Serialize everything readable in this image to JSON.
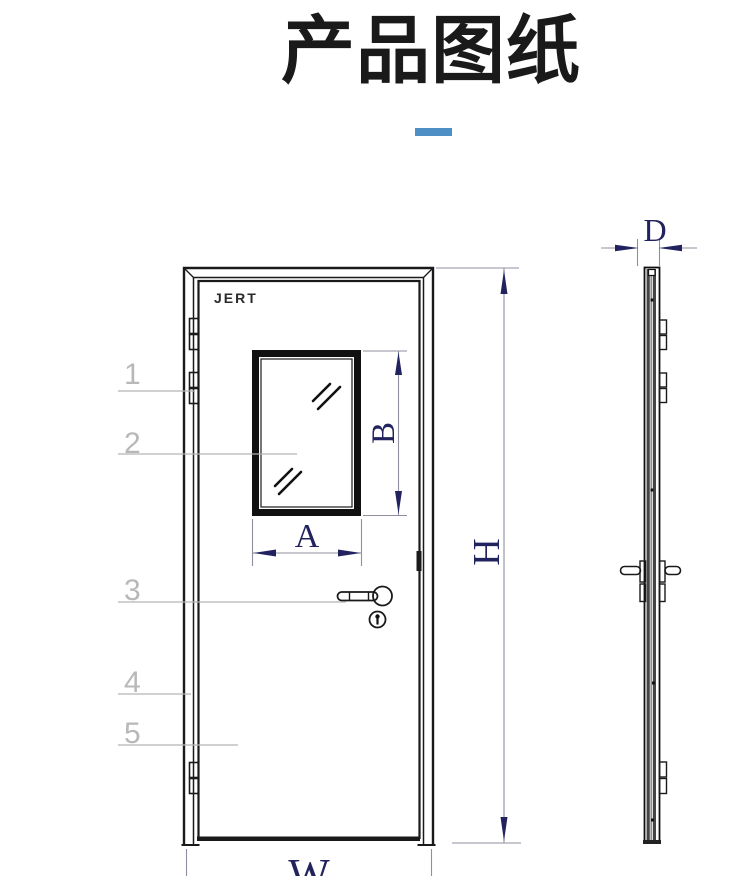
{
  "title": {
    "text": "产品图纸"
  },
  "drawing": {
    "brand_label": "JERT",
    "callouts": [
      "1",
      "2",
      "3",
      "4",
      "5"
    ],
    "dimensions": {
      "window_width": "A",
      "window_height": "B",
      "door_height": "H",
      "door_width": "W",
      "door_thickness": "D"
    }
  },
  "colors": {
    "accent_blue": "#4e8fc6",
    "dimension_navy": "#22225e",
    "line_black": "#1a1a1a",
    "callout_gray": "#b8b8b8"
  }
}
